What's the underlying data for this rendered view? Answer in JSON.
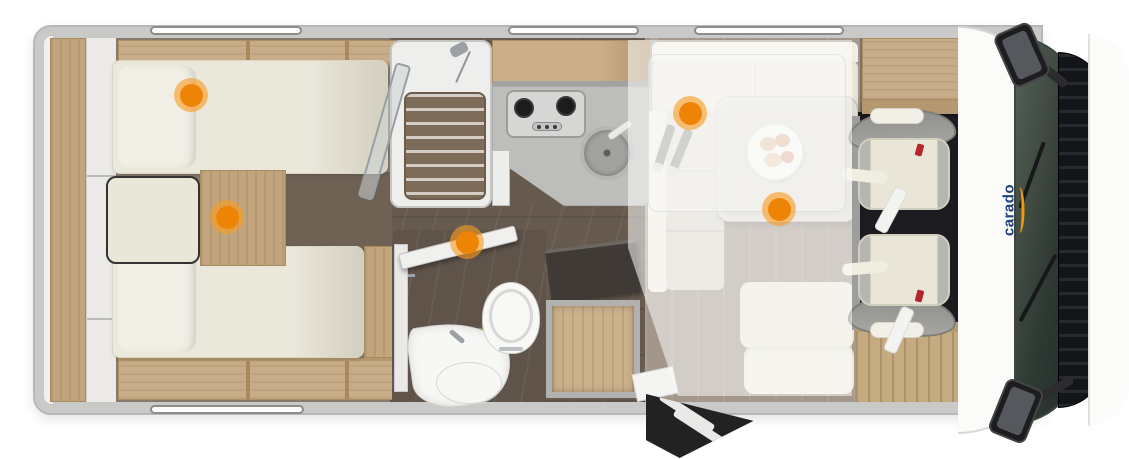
{
  "brand": {
    "logo_text": "carado",
    "logo_color": "#1e4079",
    "swoosh_color": "#f49a00"
  },
  "hotspots": {
    "marker_color": "#ee8406",
    "marker_halo_color": "rgba(247,157,36,0.62)",
    "items": [
      {
        "id": "hotspot-rear-bed-top",
        "x": 191,
        "y": 95
      },
      {
        "id": "hotspot-rear-bed-center",
        "x": 227,
        "y": 217
      },
      {
        "id": "hotspot-bathroom-door",
        "x": 467,
        "y": 242
      },
      {
        "id": "hotspot-dinette-bench",
        "x": 690,
        "y": 113
      },
      {
        "id": "hotspot-dinette-table",
        "x": 779,
        "y": 209
      }
    ]
  },
  "palette": {
    "body_gray": "#c9c9c7",
    "furniture_wood": "#c9ad88",
    "dark_floor": "#675b4f",
    "lounge_floor": "#a3968a",
    "cushion_cream": "#eae7db",
    "counter_gray": "#bdbdbb",
    "cab_floor_black": "#1c1c20",
    "windshield_dark": "#2f3a34"
  }
}
